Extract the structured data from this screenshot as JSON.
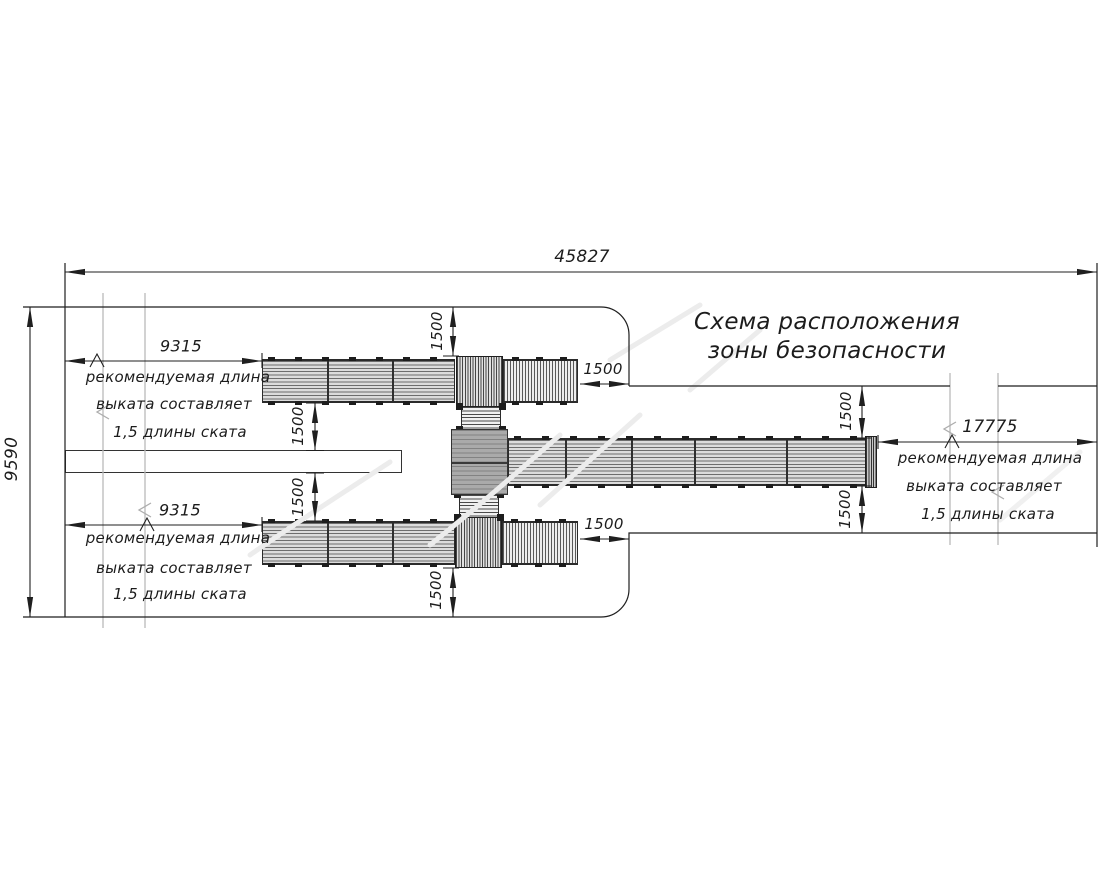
{
  "title": {
    "line1": "Схема расположения",
    "line2": "зоны безопасности"
  },
  "dimensions": {
    "total_width": "45827",
    "total_height": "9590",
    "left_runout_top": "9315",
    "left_runout_bottom": "9315",
    "right_runout": "17775",
    "clearance": "1500",
    "runout_note": {
      "l1": "рекомендуемая длина",
      "l2": "выката составляет",
      "l3": "1,5 длины ската"
    }
  },
  "colors": {
    "line": "#1f1f1f",
    "break_line": "#b9b9b9",
    "deck_fill": "#dcdcdc",
    "platform_fill": "#aaaaaa",
    "background": "#ffffff"
  }
}
